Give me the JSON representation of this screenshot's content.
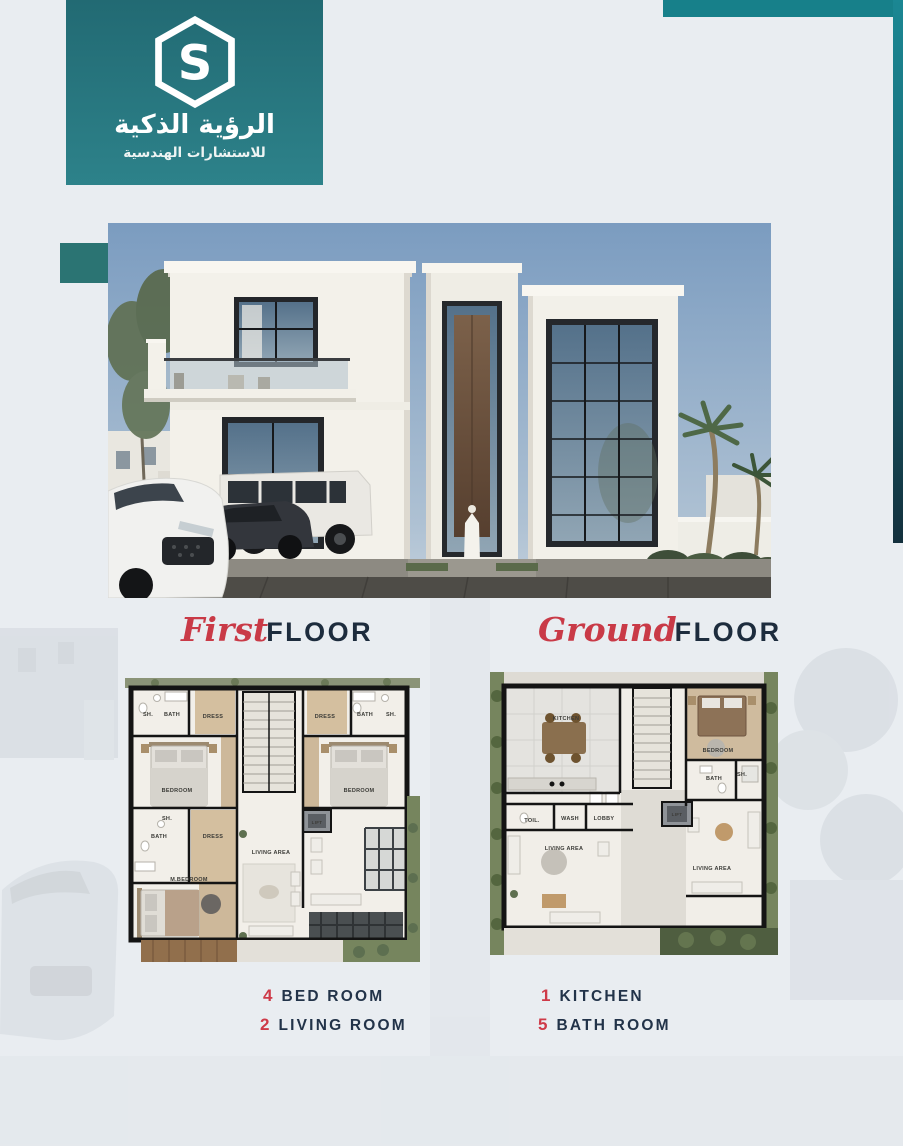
{
  "header": {
    "logo_icon": "hexagon-s-monogram-icon",
    "title_ar": "الرؤية الذكية",
    "subtitle_ar": "للاستشارات الهندسية"
  },
  "colors": {
    "banner_top": "#226a73",
    "banner_bottom": "#2d828a",
    "top_bar": "#17808a",
    "right_strip_top": "#1b8793",
    "right_strip_bottom": "#13303d",
    "accent_square": "#2b7473",
    "accent_red": "#ce3a48",
    "heading_navy": "#1d2c3d",
    "page_background": "#e9edf1"
  },
  "sections": {
    "first_floor": {
      "script": "First",
      "caps": "FLOOR"
    },
    "ground_floor": {
      "script": "Ground",
      "caps": "FLOOR"
    }
  },
  "first_plan": {
    "labels": {
      "tl_sh": "SH.",
      "tl_bath": "BATH",
      "tl_dress": "DRESS",
      "bedroom_left": "BEDROOM",
      "tr_dress": "DRESS",
      "tr_bath": "BATH",
      "tr_sh": "SH.",
      "bedroom_right": "BEDROOM",
      "ml_sh": "SH.",
      "ml_bath": "BATH",
      "ml_dress": "DRESS",
      "master_bedroom": "M.BEDROOM",
      "living_area": "LIVING AREA",
      "lift": "LIFT"
    }
  },
  "ground_plan": {
    "labels": {
      "kitchen": "KITCHEN",
      "bedroom": "BEDROOM",
      "bath": "BATH",
      "sh": "SH.",
      "toil": "TOIL.",
      "wash": "WASH",
      "lobby": "LOBBY",
      "lift": "LIFT",
      "living_left": "LIVING AREA",
      "living_right": "LIVING AREA"
    }
  },
  "stats": {
    "first": [
      {
        "value": "4",
        "label": "BED ROOM"
      },
      {
        "value": "2",
        "label": "LIVING ROOM"
      }
    ],
    "ground": [
      {
        "value": "1",
        "label": "KITCHEN"
      },
      {
        "value": "5",
        "label": "BATH ROOM"
      }
    ]
  }
}
